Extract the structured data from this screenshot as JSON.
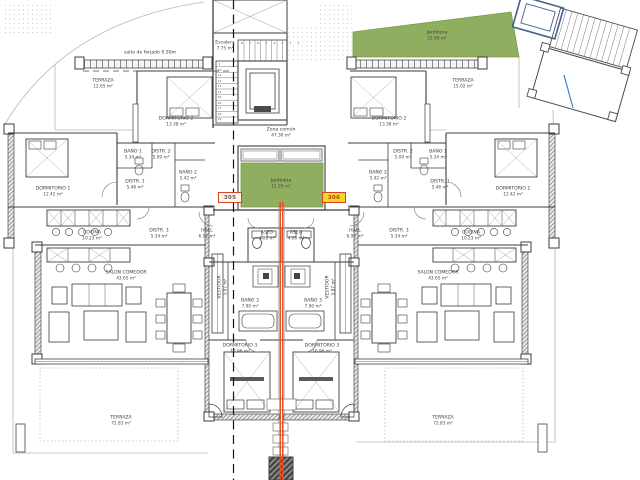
{
  "plan": {
    "note": "salto de forjado 0.50m",
    "badges": {
      "left": "305",
      "right": "306"
    },
    "common": {
      "escalera": {
        "name": "Escalera",
        "area": "7.75 m²"
      },
      "zona_comun": {
        "name": "Zona común",
        "area": "47.36 m²"
      },
      "jardinera_center": {
        "name": "Jardinera",
        "area": "11.26 m²"
      },
      "jardinera_top": {
        "name": "Jardinera",
        "area": "22.89 m²"
      }
    },
    "left": {
      "terraza_top": {
        "name": "TERRAZA",
        "area": "12.65 m²"
      },
      "dormitorio2": {
        "name": "DORMITORIO 2",
        "area": "13.38 m²"
      },
      "bano1": {
        "name": "BAÑO 1",
        "area": "5.34 m²"
      },
      "distr2": {
        "name": "DISTR. 2",
        "area": "5.09 m²"
      },
      "bano2": {
        "name": "BAÑO 2",
        "area": "5.42 m²"
      },
      "distr1": {
        "name": "DISTR. 1",
        "area": "5.46 m²"
      },
      "dormitorio1": {
        "name": "DORMITORIO 1",
        "area": "12.42 m²"
      },
      "cocina": {
        "name": "COCINA",
        "area": "10.23 m²"
      },
      "distr3": {
        "name": "DISTR. 3",
        "area": "5.34 m²"
      },
      "hall": {
        "name": "HALL",
        "area": "6.92 m²"
      },
      "aseo": {
        "name": "ASEO",
        "area": "4.06 m²"
      },
      "salon": {
        "name": "SALON COMEDOR",
        "area": "43.65 m²"
      },
      "vestidor": {
        "name": "VESTIDOR",
        "area": "5.97 m²"
      },
      "bano3": {
        "name": "BAÑO 3",
        "area": "7.90 m²"
      },
      "dormitorio3": {
        "name": "DORMITORIO 3",
        "area": "16.96 m²"
      },
      "terraza_bottom": {
        "name": "TERRAZA",
        "area": "72.83 m²"
      }
    },
    "right": {
      "terraza_top": {
        "name": "TERRAZA",
        "area": "15.02 m²"
      },
      "dormitorio2": {
        "name": "DORMITORIO 2",
        "area": "13.38 m²"
      },
      "bano1": {
        "name": "BAÑO 1",
        "area": "5.34 m²"
      },
      "distr2": {
        "name": "DISTR. 2",
        "area": "5.09 m²"
      },
      "bano2": {
        "name": "BAÑO 2",
        "area": "5.42 m²"
      },
      "distr1": {
        "name": "DISTR. 1",
        "area": "5.46 m²"
      },
      "dormitorio1": {
        "name": "DORMITORIO 1",
        "area": "12.42 m²"
      },
      "cocina": {
        "name": "COCINA",
        "area": "10.23 m²"
      },
      "distr3": {
        "name": "DISTR. 3",
        "area": "5.34 m²"
      },
      "hall": {
        "name": "HALL",
        "area": "6.92 m²"
      },
      "aseo": {
        "name": "ASEO",
        "area": "4.06 m²"
      },
      "salon": {
        "name": "SALON COMEDOR",
        "area": "43.65 m²"
      },
      "vestidor": {
        "name": "VESTIDOR",
        "area": "5.97 m²"
      },
      "bano3": {
        "name": "BAÑO 3",
        "area": "7.90 m²"
      },
      "dormitorio3": {
        "name": "DORMITORIO 3",
        "area": "16.96 m²"
      },
      "terraza_bottom": {
        "name": "TERRAZA",
        "area": "72.83 m²"
      }
    },
    "stairs": {
      "top_numbers": "8 7 6 5 4 3 2 1",
      "side_numbers": "9\n10\n11\n12\n13\n14\n15\n16\n17\n18\n19"
    },
    "colors": {
      "jardinera_green": "#8fae5f",
      "section_line_orange": "#e8481d",
      "badge_border_red": "#d3422a",
      "badge_fill_yellow": "#f4d922",
      "elevator_blue": "#41618e",
      "marker_blue": "#2e86d6"
    }
  }
}
